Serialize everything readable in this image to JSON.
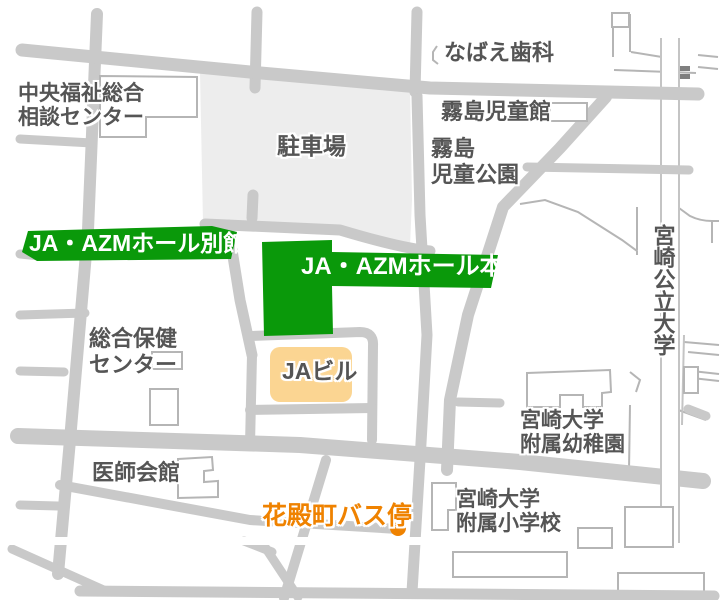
{
  "map": {
    "kind": "static-area-map",
    "labels": {
      "chuo_fukushi": "中央福祉総合\n相談センター",
      "nabae_dental": "なばえ歯科",
      "kirishima_jidokan": "霧島児童館",
      "kirishima_park": "霧島\n児童公園",
      "parking": "駐車場",
      "azm_bekkan": "JA・AZMホール別館",
      "azm_honkan": "JA・AZMホール本館",
      "miyazaki_koritsu_univ": "宮崎公立大学",
      "sogo_hoken_center": "総合保健\nセンター",
      "ja_building": "JAビル",
      "fuzoku_yochien": "宮崎大学\n附属幼稚園",
      "ishi_kaikan": "医師会館",
      "fuzoku_shogakko": "宮崎大学\n附属小学校",
      "bus_stop": "花殿町バス停"
    },
    "markers": {
      "bus_stop_dot": "花殿町バス停の位置"
    }
  },
  "colors": {
    "green": "#0A990A",
    "road": "#C9C9C9",
    "parking": "#EDEDED",
    "thin": "#B5B5B5",
    "corridor-border": "#C4C4C4",
    "ja-fill": "#FBD592",
    "orange": "#EF8200",
    "label": "#555555",
    "white": "#FFFFFF",
    "dash": "#7F7F7F"
  }
}
